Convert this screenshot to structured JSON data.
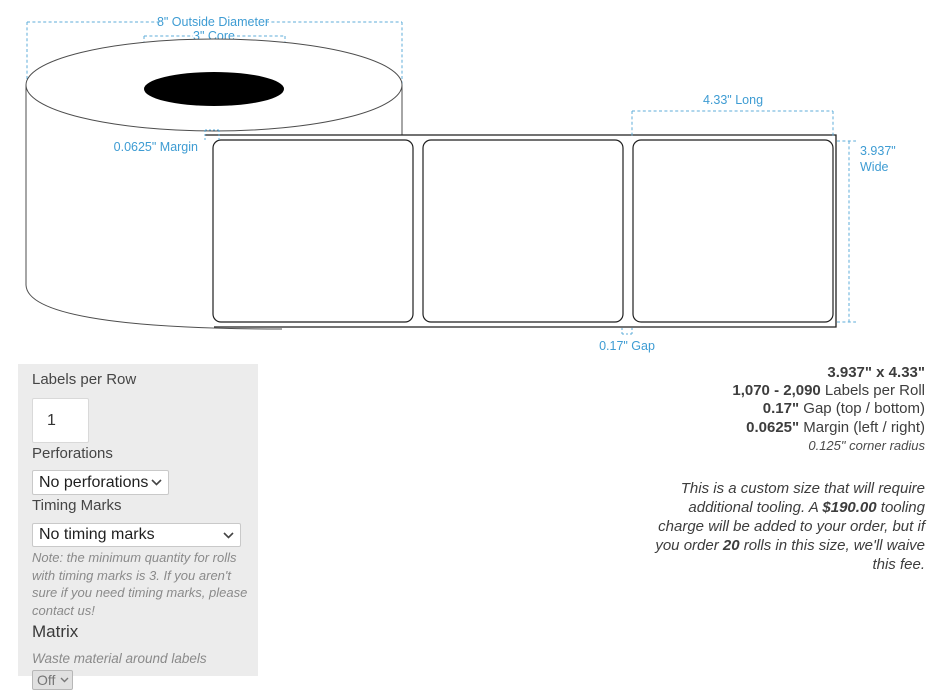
{
  "colors": {
    "dimension_accent": "#3e9cd3",
    "dimension_dash": "#5fadda",
    "panel_background": "#ececec",
    "diagram_stroke": "#1f1f1f"
  },
  "diagram": {
    "outside_diameter": "8\" Outside Diameter",
    "core": "3\" Core",
    "margin": "0.0625\" Margin",
    "long": "4.33\" Long",
    "wide_value": "3.937\"",
    "wide_word": "Wide",
    "gap": "0.17\" Gap"
  },
  "options_panel": {
    "labels_per_row": {
      "label": "Labels per Row",
      "value": "1"
    },
    "perforations": {
      "label": "Perforations",
      "selected": "No perforations"
    },
    "timing_marks": {
      "label": "Timing Marks",
      "selected": "No timing marks",
      "note": "Note: the minimum quantity for rolls with timing marks is 3. If you aren't sure if you need timing marks, please contact us!"
    },
    "matrix": {
      "label": "Matrix",
      "description": "Waste material around labels",
      "selected": "Off"
    }
  },
  "specs": {
    "size": "3.937\" x 4.33\"",
    "labels_per_roll_value": "1,070 - 2,090",
    "labels_per_roll_label": " Labels per Roll",
    "gap_value": "0.17\"",
    "gap_label": " Gap (top / bottom)",
    "margin_value": "0.0625\"",
    "margin_label": " Margin (left / right)",
    "corner_radius": "0.125\" corner radius",
    "tooling_note": {
      "part1": "This is a custom size that will require additional tooling. A ",
      "price": "$190.00",
      "part2": " tooling charge will be added to your order, but if you order ",
      "quantity": "20",
      "part3": " rolls in this size, we'll waive this fee."
    }
  }
}
